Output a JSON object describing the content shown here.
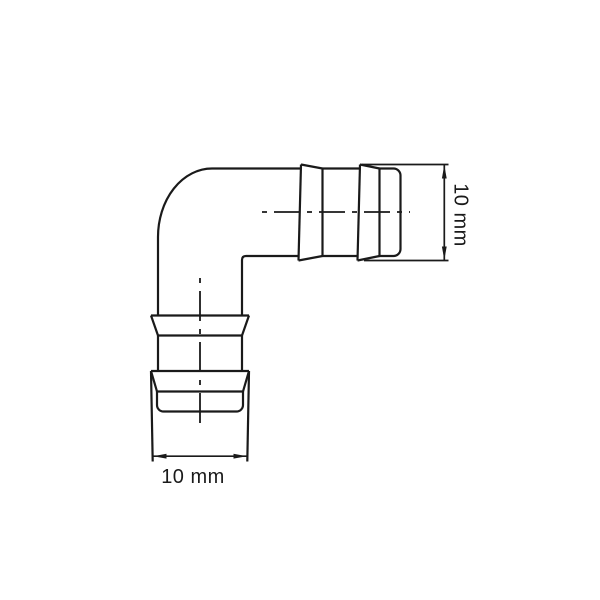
{
  "drawing": {
    "colors": {
      "background": "#ffffff",
      "line": "#1a1a1a"
    },
    "dimensions": {
      "right": {
        "label": "10 mm"
      },
      "bottom": {
        "label": "10 mm"
      }
    }
  }
}
